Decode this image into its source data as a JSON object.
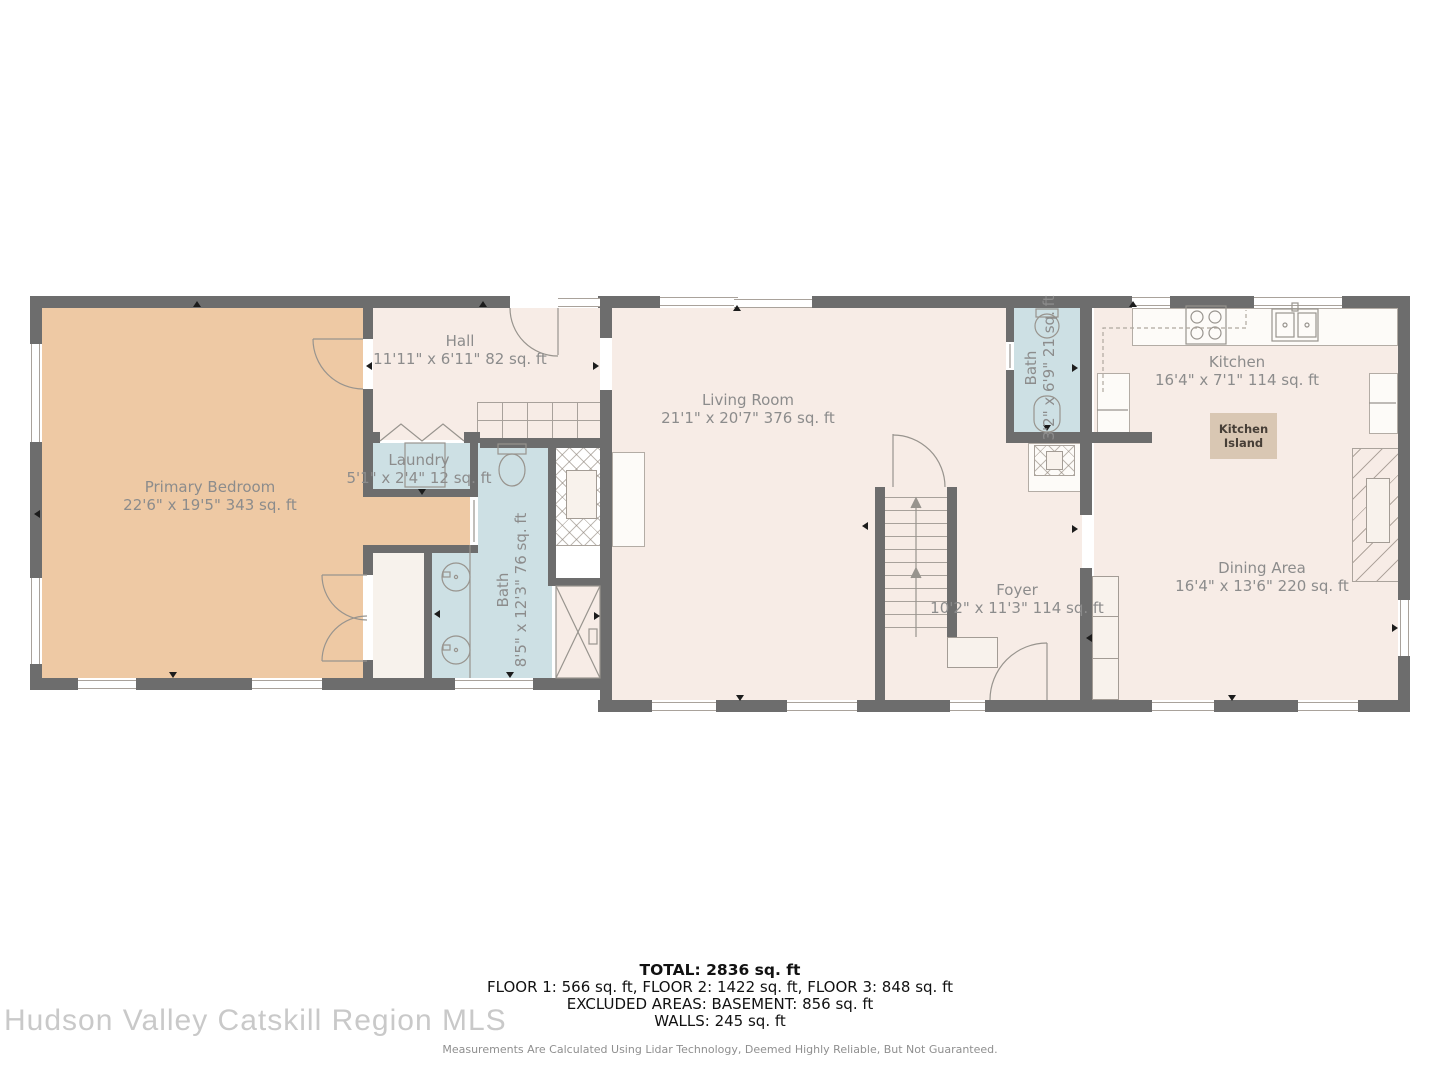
{
  "watermark": "Hudson Valley Catskill Region MLS",
  "rooms": {
    "primary_bedroom": {
      "name": "Primary Bedroom",
      "dims": "22'6\" x 19'5\" 343 sq. ft"
    },
    "hall": {
      "name": "Hall",
      "dims": "11'11\" x 6'11\" 82 sq. ft"
    },
    "laundry": {
      "name": "Laundry",
      "dims": "5'1\" x 2'4\" 12 sq. ft"
    },
    "bath_primary": {
      "name": "Bath",
      "dims": "8'5\" x 12'3\" 76 sq. ft"
    },
    "living_room": {
      "name": "Living Room",
      "dims": "21'1\" x 20'7\" 376 sq. ft"
    },
    "bath_half": {
      "name": "Bath",
      "dims": "3'2\" x 6'9\" 21 sq. ft"
    },
    "foyer": {
      "name": "Foyer",
      "dims": "10'2\" x 11'3\" 114 sq. ft"
    },
    "kitchen": {
      "name": "Kitchen",
      "dims": "16'4\" x 7'1\" 114 sq. ft"
    },
    "kitchen_island": {
      "label": "Kitchen Island"
    },
    "dining_area": {
      "name": "Dining Area",
      "dims": "16'4\" x 13'6\" 220 sq. ft"
    }
  },
  "summary": {
    "total": "TOTAL: 2836 sq. ft",
    "floors": "FLOOR 1: 566 sq. ft, FLOOR 2: 1422 sq. ft, FLOOR 3: 848 sq. ft",
    "excluded": "EXCLUDED AREAS: BASEMENT: 856 sq. ft",
    "walls": "WALLS: 245 sq. ft"
  },
  "disclaimer": "Measurements Are Calculated Using Lidar Technology, Deemed Highly Reliable, But Not Guaranteed.",
  "colors": {
    "wall": "#6d6d6d",
    "room": "#f7ece6",
    "bedroom": "#eec9a4",
    "bath": "#cde0e4",
    "island": "#d9c7b3"
  }
}
